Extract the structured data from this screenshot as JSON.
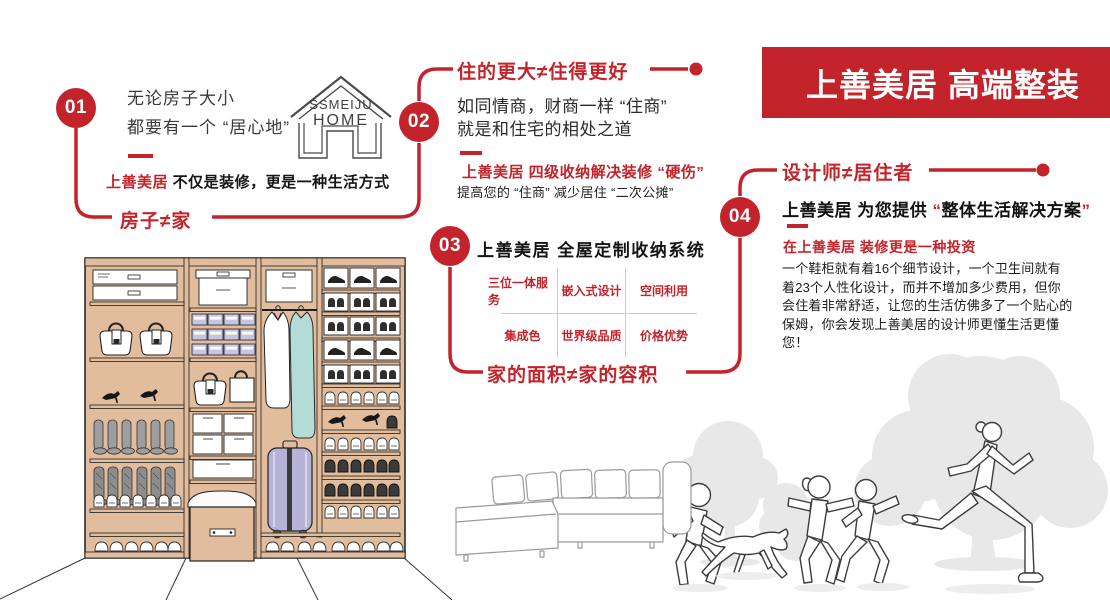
{
  "banner": {
    "title": "上善美居 高端整装"
  },
  "logo": {
    "line1": "SSMEIJU",
    "line2": "HOME"
  },
  "steps": {
    "s1": {
      "number": "01",
      "intro_line1": "无论房子大小",
      "intro_line2": "都要有一个 “居心地”",
      "brand": "上善美居 ",
      "slogan": "不仅是装修，更是一种生活方式",
      "tagline": "房子≠家"
    },
    "s2": {
      "number": "02",
      "title": "住的更大≠住得更好",
      "body_line1": "如同情商，财商一样 “住商”",
      "body_line2": "就是和住宅的相处之道",
      "highlight": "上善美居 四级收纳解决装修 “硬伤”",
      "note": "提高您的 “住商” 减少居住 “二次公摊”"
    },
    "s3": {
      "number": "03",
      "title": "上善美居 全屋定制收纳系统",
      "grid": {
        "r1c1": "三位一体服务",
        "r1c2": "嵌入式设计",
        "r1c3": "空间利用",
        "r2c1": "集成色",
        "r2c2": "世界级品质",
        "r2c3": "价格优势"
      },
      "tagline": "家的面积≠家的容积"
    },
    "s4": {
      "number": "04",
      "title": "设计师≠居住者",
      "subtitle_brand": "上善美居 ",
      "subtitle_mid": "为您提供 ",
      "quote_open": "“",
      "subtitle_quoted": "整体生活解决方案",
      "quote_close": "”",
      "highlight": "在上善美居 装修更是一种投资",
      "paragraph": "一个鞋柜就有着16个细节设计，一个卫生间就有着23个人性化设计，而并不增加多少费用，但你会住着非常舒适，让您的生活仿佛多了一个贴心的保姆，你会发现上善美居的设计师更懂生活更懂您！"
    }
  },
  "colors": {
    "accent_red": "#c3242b",
    "wood_tan": "#e2bd9d",
    "lavender": "#c6c4e2",
    "teal": "#b4dcd7",
    "tree_gray": "#e8e8e8"
  }
}
